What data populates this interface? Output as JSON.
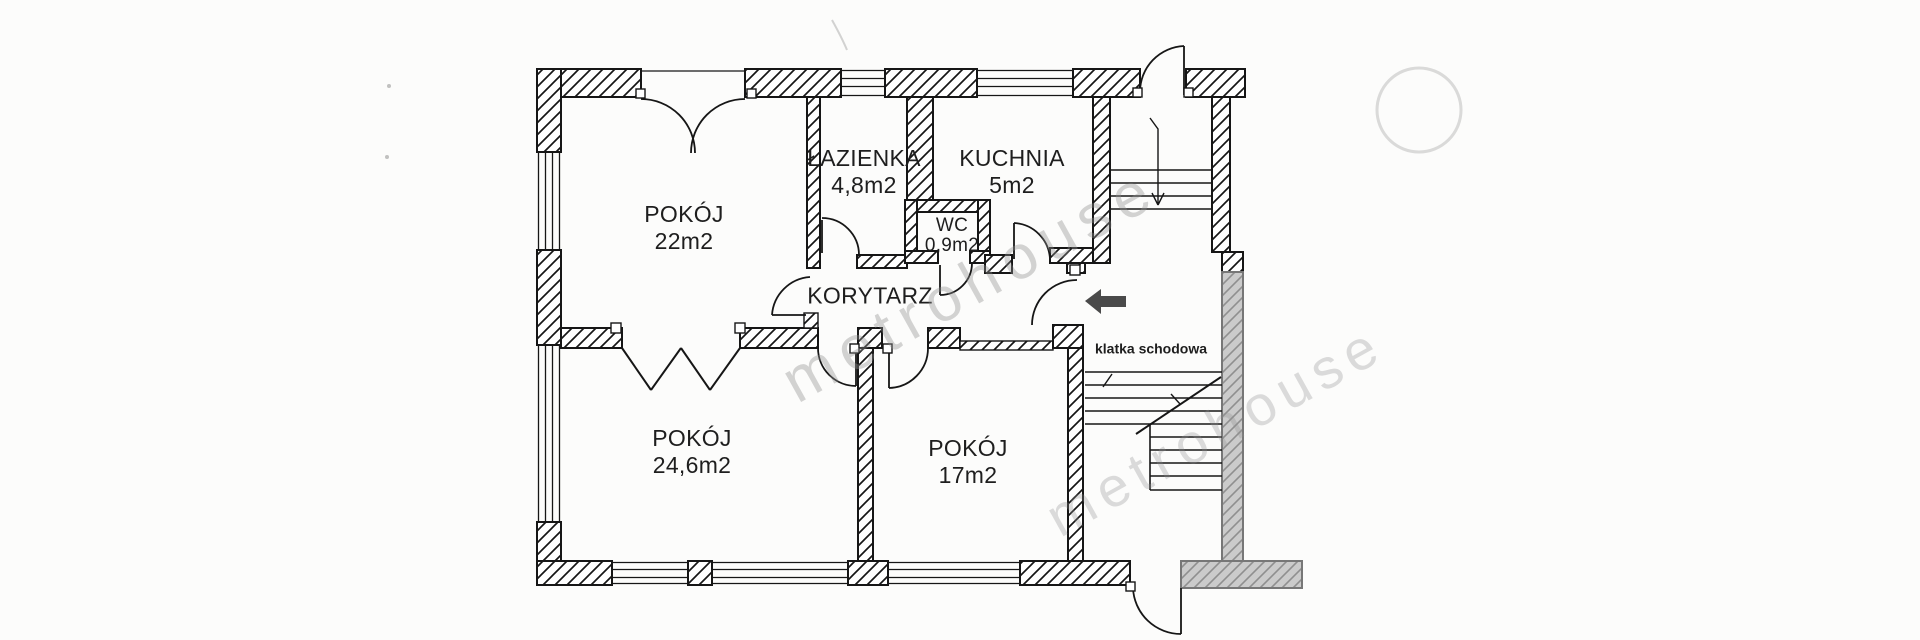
{
  "watermark": {
    "text": "metrohouse",
    "color": "#8f8f8f"
  },
  "plan": {
    "rooms": [
      {
        "id": "pokoj-22",
        "name": "POKÓJ",
        "area": "22m2"
      },
      {
        "id": "lazienka",
        "name": "ŁAZIENKA",
        "area": "4,8m2"
      },
      {
        "id": "kuchnia",
        "name": "KUCHNIA",
        "area": "5m2"
      },
      {
        "id": "wc",
        "name": "WC",
        "area": "0,9m2"
      },
      {
        "id": "korytarz",
        "name": "KORYTARZ",
        "area": ""
      },
      {
        "id": "pokoj-246",
        "name": "POKÓJ",
        "area": "24,6m2"
      },
      {
        "id": "pokoj-17",
        "name": "POKÓJ",
        "area": "17m2"
      }
    ],
    "staircase_label": "klatka schodowa",
    "icons": {
      "entry_arrow": "arrow-left-icon"
    },
    "colors": {
      "wall_line": "#1b1b1b",
      "gray_wall_fill": "#c8c8c8",
      "gray_wall_line": "#8f8f8f",
      "arrow": "#4a4a4a",
      "watermark": "#8f8f8f"
    }
  }
}
